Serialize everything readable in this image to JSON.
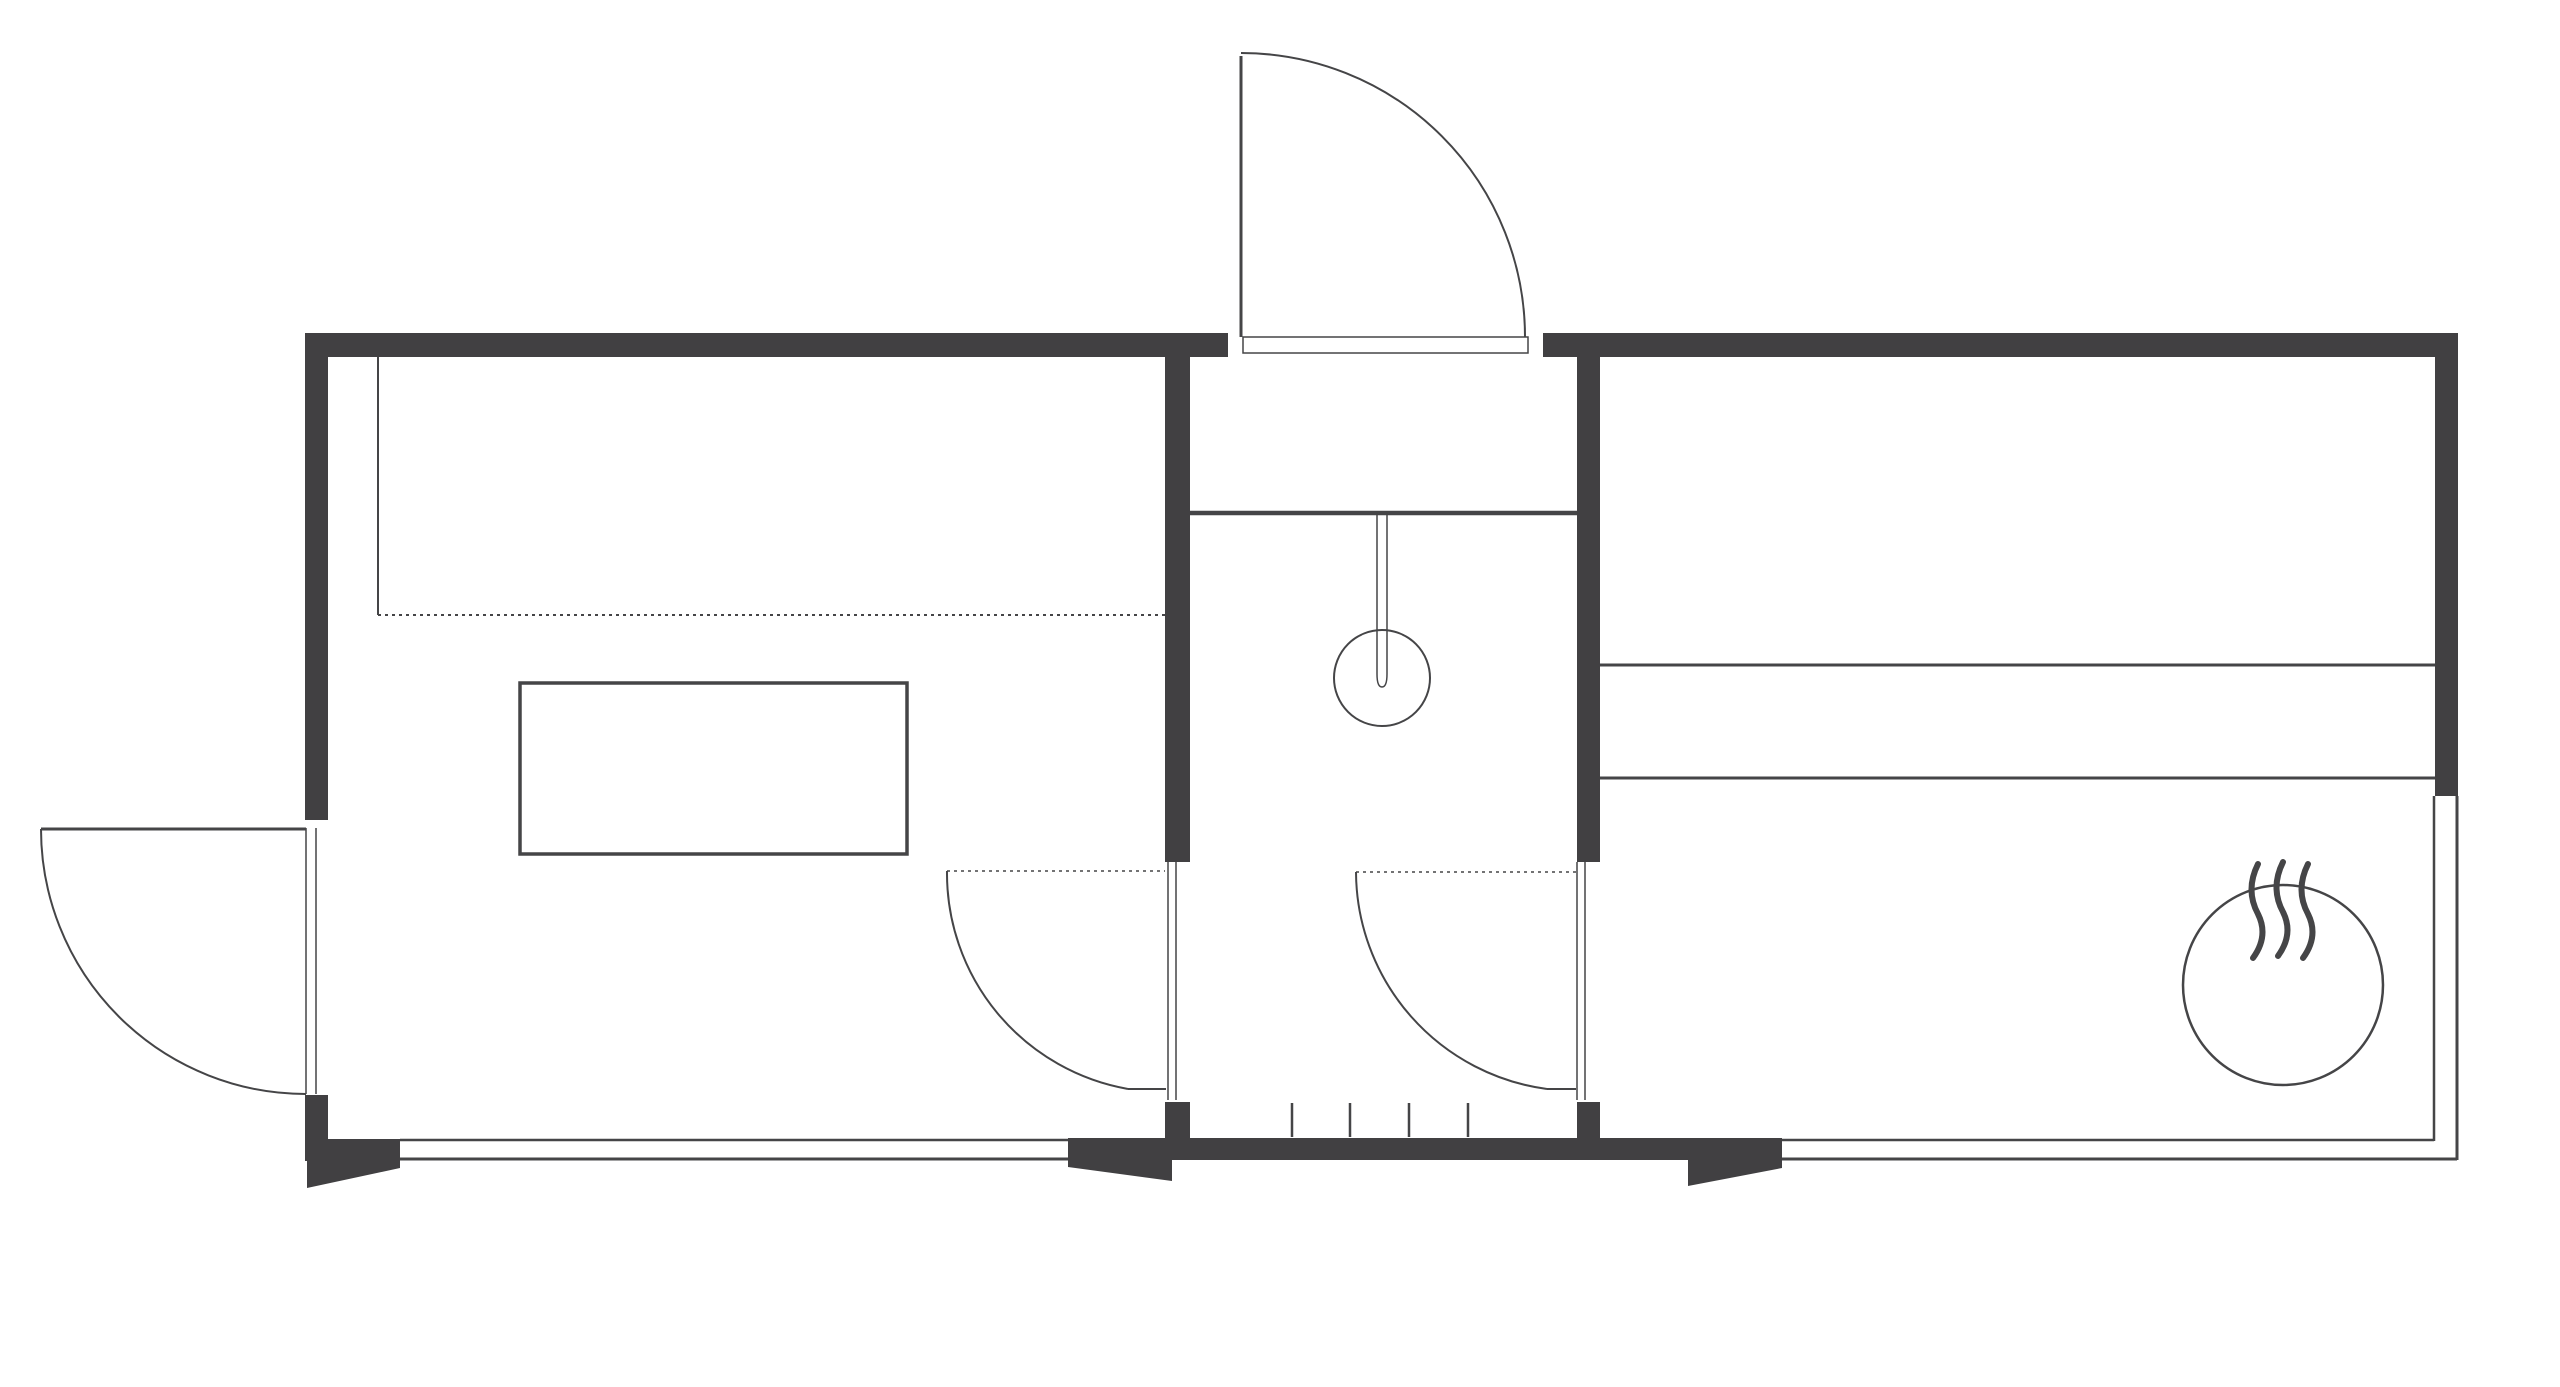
{
  "canvas": {
    "width": 2560,
    "height": 1387,
    "viewBox": "0 0 2560 1387"
  },
  "colors": {
    "background": "#ffffff",
    "wall": "#414042",
    "line": "#454547"
  },
  "plan": {
    "rects": [
      {
        "name": "wall-top-left",
        "x": 305,
        "y": 333,
        "w": 923,
        "h": 24
      },
      {
        "name": "wall-top-right",
        "x": 1543,
        "y": 333,
        "w": 915,
        "h": 24
      },
      {
        "name": "wall-left-upper",
        "x": 305,
        "y": 333,
        "w": 23,
        "h": 487
      },
      {
        "name": "wall-left-stub",
        "x": 305,
        "y": 1095,
        "w": 23,
        "h": 66
      },
      {
        "name": "wall-right-upper",
        "x": 2435,
        "y": 333,
        "w": 23,
        "h": 463
      },
      {
        "name": "wall-partition-left",
        "x": 1165,
        "y": 357,
        "w": 25,
        "h": 505
      },
      {
        "name": "wall-partition-left-stub",
        "x": 1165,
        "y": 1102,
        "w": 25,
        "h": 37
      },
      {
        "name": "wall-partition-right",
        "x": 1577,
        "y": 357,
        "w": 23,
        "h": 505
      },
      {
        "name": "wall-partition-right-stub",
        "x": 1577,
        "y": 1102,
        "w": 23,
        "h": 37
      },
      {
        "name": "vestibule-floor-band",
        "x": 1068,
        "y": 1138,
        "w": 714,
        "h": 22
      }
    ],
    "stroke_rects": [
      {
        "name": "entry-door-sill",
        "x": 1243,
        "y": 337,
        "w": 285,
        "h": 16,
        "sw": 1.5
      },
      {
        "name": "table",
        "x": 520,
        "y": 683,
        "w": 387,
        "h": 171,
        "sw": 3.5
      }
    ],
    "polygons": [
      {
        "name": "ramp-left-corner",
        "points": "307,1139 400,1139 400,1168 307,1188"
      },
      {
        "name": "ramp-vestibule-left",
        "points": "1068,1160 1172,1160 1172,1181 1068,1167"
      },
      {
        "name": "ramp-vestibule-right",
        "points": "1688,1160 1782,1160 1782,1168 1688,1186"
      }
    ],
    "lines": [
      {
        "name": "window-bottom-left-inner",
        "x1": 400,
        "y1": 1140,
        "x2": 1068,
        "y2": 1140,
        "sw": 2.5
      },
      {
        "name": "window-bottom-left-outer",
        "x1": 400,
        "y1": 1159,
        "x2": 1068,
        "y2": 1159,
        "sw": 3
      },
      {
        "name": "window-bottom-right-inner",
        "x1": 1782,
        "y1": 1140,
        "x2": 2434,
        "y2": 1140,
        "sw": 2.5
      },
      {
        "name": "window-bottom-right-outer",
        "x1": 1782,
        "y1": 1159,
        "x2": 2457,
        "y2": 1159,
        "sw": 3
      },
      {
        "name": "window-right-inner",
        "x1": 2434,
        "y1": 796,
        "x2": 2434,
        "y2": 1141,
        "sw": 2.5
      },
      {
        "name": "window-right-outer",
        "x1": 2457,
        "y1": 796,
        "x2": 2457,
        "y2": 1160,
        "sw": 3
      },
      {
        "name": "bedroom-band-upper",
        "x1": 1600,
        "y1": 665,
        "x2": 2435,
        "y2": 665,
        "sw": 3
      },
      {
        "name": "bedroom-band-lower",
        "x1": 1600,
        "y1": 778,
        "x2": 2435,
        "y2": 778,
        "sw": 3
      },
      {
        "name": "shower-partition",
        "x1": 1190,
        "y1": 513,
        "x2": 1577,
        "y2": 513,
        "sw": 4.5
      },
      {
        "name": "counter-side-edge",
        "x1": 378,
        "y1": 357,
        "x2": 378,
        "y2": 615,
        "sw": 2
      },
      {
        "name": "counter-front-edge",
        "x1": 378,
        "y1": 615,
        "x2": 1165,
        "y2": 615,
        "sw": 2,
        "dash": "3 4"
      },
      {
        "name": "left-door-jamb-outer",
        "x1": 306,
        "y1": 828,
        "x2": 306,
        "y2": 1094,
        "sw": 1.5
      },
      {
        "name": "left-door-jamb-inner",
        "x1": 316,
        "y1": 828,
        "x2": 316,
        "y2": 1094,
        "sw": 1.5
      },
      {
        "name": "left-door-leaf",
        "x1": 41,
        "y1": 829,
        "x2": 306,
        "y2": 829,
        "sw": 3
      },
      {
        "name": "entry-door-leaf",
        "x1": 1241,
        "y1": 56,
        "x2": 1241,
        "y2": 337,
        "sw": 3
      },
      {
        "name": "door-left-leaf-a",
        "x1": 1168,
        "y1": 862,
        "x2": 1168,
        "y2": 1100,
        "sw": 1.5
      },
      {
        "name": "door-left-leaf-b",
        "x1": 1176,
        "y1": 862,
        "x2": 1176,
        "y2": 1100,
        "sw": 1.5
      },
      {
        "name": "door-right-leaf-a",
        "x1": 1577,
        "y1": 862,
        "x2": 1577,
        "y2": 1100,
        "sw": 1.5
      },
      {
        "name": "door-right-leaf-b",
        "x1": 1585,
        "y1": 862,
        "x2": 1585,
        "y2": 1100,
        "sw": 1.5
      },
      {
        "name": "door-left-swing-line",
        "x1": 947,
        "y1": 871,
        "x2": 1165,
        "y2": 871,
        "sw": 1.5,
        "dash": "3 4"
      },
      {
        "name": "door-right-swing-line",
        "x1": 1356,
        "y1": 872,
        "x2": 1577,
        "y2": 872,
        "sw": 1.5,
        "dash": "3 4"
      },
      {
        "name": "door-left-arc-foot",
        "x1": 1128,
        "y1": 1089,
        "x2": 1166,
        "y2": 1089,
        "sw": 2
      },
      {
        "name": "door-right-arc-foot",
        "x1": 1547,
        "y1": 1089,
        "x2": 1576,
        "y2": 1089,
        "sw": 2
      },
      {
        "name": "stair-tick-1",
        "x1": 1292,
        "y1": 1103,
        "x2": 1292,
        "y2": 1137,
        "sw": 2.5
      },
      {
        "name": "stair-tick-2",
        "x1": 1350,
        "y1": 1103,
        "x2": 1350,
        "y2": 1137,
        "sw": 2.5
      },
      {
        "name": "stair-tick-3",
        "x1": 1409,
        "y1": 1103,
        "x2": 1409,
        "y2": 1137,
        "sw": 2.5
      },
      {
        "name": "stair-tick-4",
        "x1": 1468,
        "y1": 1103,
        "x2": 1468,
        "y2": 1137,
        "sw": 2.5
      }
    ],
    "paths": [
      {
        "name": "entry-door-arc",
        "d": "M 1241 53 A 284 284 0 0 1 1525 337",
        "sw": 2
      },
      {
        "name": "left-door-arc",
        "d": "M 41 829 A 265 265 0 0 0 306 1094",
        "sw": 2
      },
      {
        "name": "door-left-arc",
        "d": "M 947 871 A 219 219 0 0 0 1128 1089",
        "sw": 2
      },
      {
        "name": "door-right-arc",
        "d": "M 1356 872 A 220 220 0 0 0 1547 1089",
        "sw": 2
      },
      {
        "name": "shower-rod",
        "d": "M 1377 513 L 1377 674 Q 1377 687 1382 687 Q 1387 687 1387 674 L 1387 513",
        "sw": 1.5
      },
      {
        "name": "heater-steam-wave-1",
        "d": "M 2258 864 q -13 26 0 50 q 11 22 -5 44",
        "sw": 6,
        "cap": "round"
      },
      {
        "name": "heater-steam-wave-2",
        "d": "M 2283 862 q -13 26 0 50 q 11 22 -5 44",
        "sw": 6,
        "cap": "round"
      },
      {
        "name": "heater-steam-wave-3",
        "d": "M 2308 864 q -13 26 0 50 q 11 22 -5 44",
        "sw": 6,
        "cap": "round"
      }
    ],
    "circles": [
      {
        "name": "shower-head",
        "cx": 1382,
        "cy": 678,
        "r": 48,
        "sw": 2
      },
      {
        "name": "heater",
        "cx": 2283,
        "cy": 985,
        "r": 100,
        "sw": 2.5
      }
    ]
  }
}
